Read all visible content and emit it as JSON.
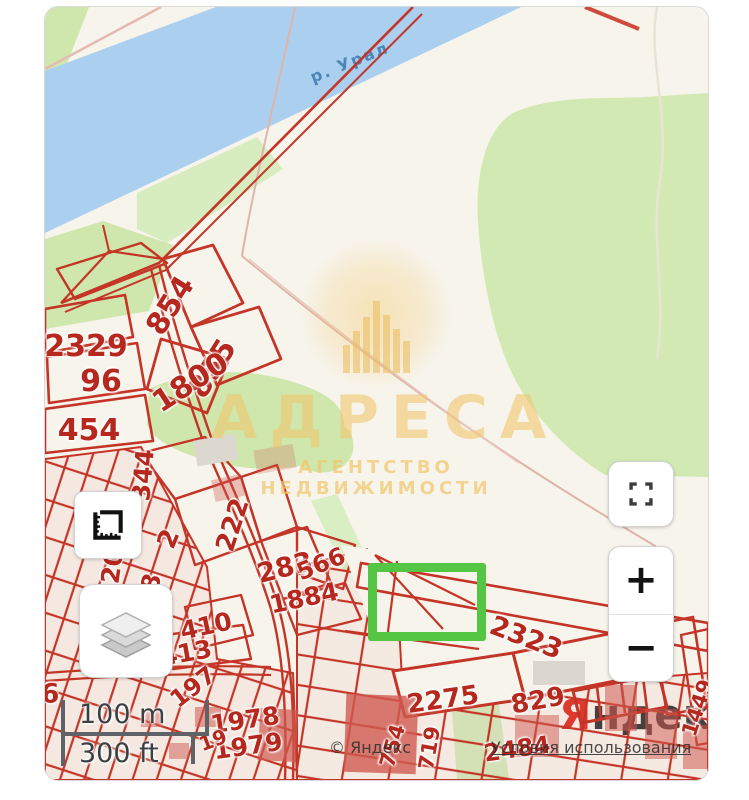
{
  "map": {
    "river_label": "р. Урал",
    "watermark": {
      "title": "АДРЕСА",
      "subtitle": "АГЕНТСТВО НЕДВИЖИМОСТИ"
    },
    "scale_bar": {
      "metric": "100 m",
      "imperial": "300 ft"
    },
    "attribution": {
      "copyright": "© Яндекс",
      "terms_link": "Условия использования"
    },
    "provider_logo": {
      "prefix": "Я",
      "suffix": "ндекс"
    },
    "controls": {
      "zoom_in": "+",
      "zoom_out": "−"
    },
    "icons": {
      "measure": "ruler-icon",
      "layers": "layer-stack-icon",
      "fullscreen": "fullscreen-corners-icon",
      "zoom_in": "plus-icon",
      "zoom_out": "minus-icon"
    },
    "colors": {
      "land": "#f7f4ec",
      "water": "#abcfee",
      "vegetation": "#cfe7ad",
      "parcel_line": "#c43528",
      "parcel_label": "#b6271d",
      "selection": "#55c544",
      "watermark_gold": "#eec468",
      "logo_red": "#e0372c"
    },
    "parcel_labels": [
      {
        "text": "2329",
        "x": 41,
        "y": 340,
        "rot": 0,
        "size": 30
      },
      {
        "text": "96",
        "x": 56,
        "y": 375,
        "rot": 0,
        "size": 30
      },
      {
        "text": "454",
        "x": 44,
        "y": 424,
        "rot": 0,
        "size": 30
      },
      {
        "text": "854",
        "x": 126,
        "y": 299,
        "rot": -58,
        "size": 30
      },
      {
        "text": "855",
        "x": 168,
        "y": 362,
        "rot": -58,
        "size": 30
      },
      {
        "text": "1800",
        "x": 146,
        "y": 376,
        "rot": -33,
        "size": 30
      },
      {
        "text": "344",
        "x": 98,
        "y": 468,
        "rot": -85,
        "size": 25
      },
      {
        "text": "2",
        "x": 124,
        "y": 532,
        "rot": -68,
        "size": 26
      },
      {
        "text": "222",
        "x": 188,
        "y": 518,
        "rot": -72,
        "size": 26
      },
      {
        "text": "283",
        "x": 240,
        "y": 561,
        "rot": -14,
        "size": 27
      },
      {
        "text": "120",
        "x": 66,
        "y": 568,
        "rot": -82,
        "size": 25
      },
      {
        "text": "28",
        "x": 104,
        "y": 584,
        "rot": -76,
        "size": 25
      },
      {
        "text": "566",
        "x": 276,
        "y": 557,
        "rot": -22,
        "size": 24
      },
      {
        "text": "1884",
        "x": 259,
        "y": 591,
        "rot": -12,
        "size": 25
      },
      {
        "text": "410",
        "x": 161,
        "y": 619,
        "rot": -12,
        "size": 25
      },
      {
        "text": "413",
        "x": 141,
        "y": 646,
        "rot": -10,
        "size": 25
      },
      {
        "text": "197",
        "x": 148,
        "y": 680,
        "rot": -38,
        "size": 24
      },
      {
        "text": "1978",
        "x": 200,
        "y": 713,
        "rot": -8,
        "size": 25
      },
      {
        "text": "1979",
        "x": 203,
        "y": 739,
        "rot": -8,
        "size": 25
      },
      {
        "text": "19",
        "x": 168,
        "y": 733,
        "rot": -20,
        "size": 20
      },
      {
        "text": "6",
        "x": 5,
        "y": 687,
        "rot": 0,
        "size": 27
      },
      {
        "text": "2275",
        "x": 398,
        "y": 693,
        "rot": -8,
        "size": 26
      },
      {
        "text": "829",
        "x": 493,
        "y": 694,
        "rot": -10,
        "size": 26
      },
      {
        "text": "2323",
        "x": 481,
        "y": 631,
        "rot": 21,
        "size": 27
      },
      {
        "text": "1449",
        "x": 653,
        "y": 701,
        "rot": -72,
        "size": 21
      },
      {
        "text": "754",
        "x": 348,
        "y": 739,
        "rot": -74,
        "size": 21
      },
      {
        "text": "719",
        "x": 385,
        "y": 741,
        "rot": -80,
        "size": 21
      },
      {
        "text": "2484",
        "x": 472,
        "y": 742,
        "rot": -8,
        "size": 24
      }
    ]
  }
}
